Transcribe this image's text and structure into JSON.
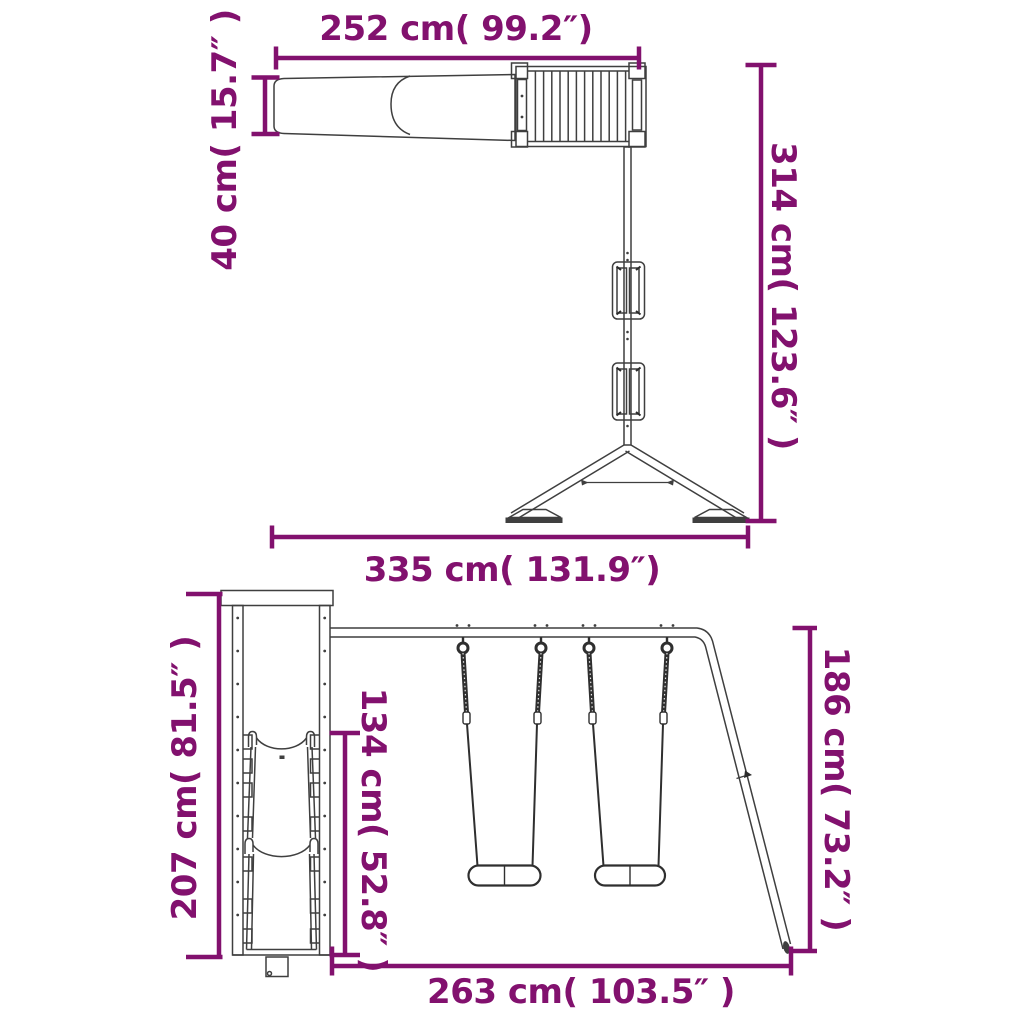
{
  "colors": {
    "dimension_accent": "#82116E",
    "drawing_line": "#3f3f3f",
    "background": "#ffffff"
  },
  "top_view": {
    "dimensions": {
      "slide_and_platform_width": "252 cm( 99.2″)",
      "slide_width": "40 cm( 15.7″ )",
      "overall_depth": "314 cm( 123.6″ )",
      "overall_width": "335 cm( 131.9″)"
    }
  },
  "front_view": {
    "dimensions": {
      "tower_height": "207 cm( 81.5″ )",
      "swing_hanging_height": "134 cm( 52.8″ )",
      "swing_frame_height": "186 cm( 73.2″ )",
      "swing_section_width": "263 cm( 103.5″ )"
    }
  }
}
